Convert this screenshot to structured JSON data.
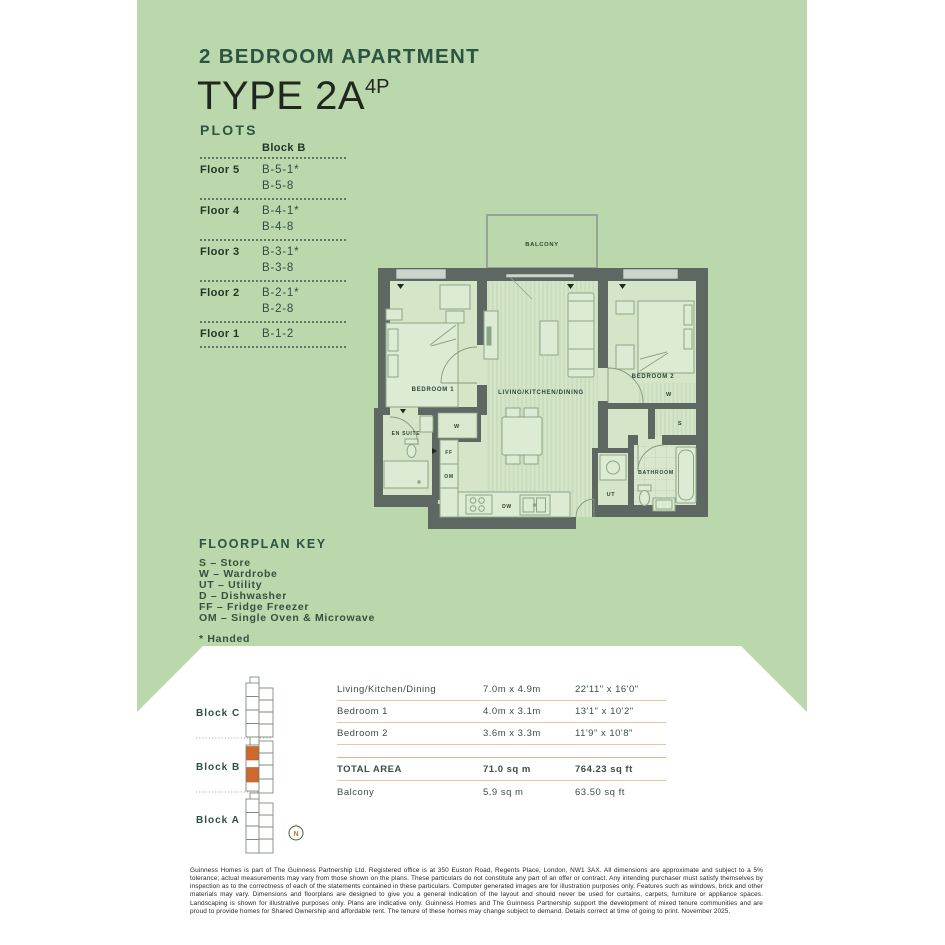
{
  "page": {
    "title_line1": "2 BEDROOM APARTMENT",
    "title_line2": "TYPE 2A",
    "title_superscript": "4P"
  },
  "plots": {
    "heading": "PLOTS",
    "column_header": "Block B",
    "rows": [
      {
        "floor": "Floor 5",
        "plots": [
          "B-5-1*",
          "B-5-8"
        ]
      },
      {
        "floor": "Floor 4",
        "plots": [
          "B-4-1*",
          "B-4-8"
        ]
      },
      {
        "floor": "Floor 3",
        "plots": [
          "B-3-1*",
          "B-3-8"
        ]
      },
      {
        "floor": "Floor 2",
        "plots": [
          "B-2-1*",
          "B-2-8"
        ]
      },
      {
        "floor": "Floor 1",
        "plots": [
          "B-1-2"
        ]
      }
    ]
  },
  "floorplan": {
    "labels": {
      "balcony": "BALCONY",
      "bedroom1": "BEDROOM 1",
      "living": "LIVING/KITCHEN/DINING",
      "bedroom2": "BEDROOM 2",
      "ensuite": "EN SUITE",
      "bathroom": "BATHROOM",
      "wardrobe": "W",
      "store": "S",
      "utility": "UT",
      "fridge_freezer": "FF",
      "oven_microwave": "OM",
      "dishwasher": "DW"
    }
  },
  "key": {
    "heading": "FLOORPLAN KEY",
    "items": [
      "S – Store",
      "W – Wardrobe",
      "UT – Utility",
      "D – Dishwasher",
      "FF – Fridge Freezer",
      "OM – Single Oven & Microwave"
    ],
    "note": "* Handed"
  },
  "siteplan": {
    "blocks": [
      "Block C",
      "Block B",
      "Block A"
    ],
    "compass": "N"
  },
  "dimensions": {
    "rows": [
      {
        "name": "Living/Kitchen/Dining",
        "metric": "7.0m x 4.9m",
        "imperial": "22'11\" x 16'0\""
      },
      {
        "name": "Bedroom 1",
        "metric": "4.0m x 3.1m",
        "imperial": "13'1\" x 10'2\""
      },
      {
        "name": "Bedroom 2",
        "metric": "3.6m x 3.3m",
        "imperial": "11'9\" x 10'8\""
      }
    ],
    "total": {
      "name": "TOTAL AREA",
      "metric": "71.0 sq m",
      "imperial": "764.23 sq ft"
    },
    "balcony": {
      "name": "Balcony",
      "metric": "5.9 sq m",
      "imperial": "63.50 sq ft"
    }
  },
  "disclaimer": "Guinness Homes is part of The Guinness Partnership Ltd. Registered office is at 350 Euston Road, Regents Place, London, NW1 3AX. All dimensions are approximate and subject to a 5% tolerance; actual measurements may vary from those shown on the plans. These particulars do not constitute any part of an offer or contract. Any intending purchaser must satisfy themselves by inspection as to the correctness of each of the statements contained in these particulars. Computer generated images are for illustration purposes only. Features such as windows, brick and other materials may vary. Dimensions and floorplans are designed to give you a general indication of the layout and should never be used for curtains, carpets, furniture or appliance spaces. Landscaping is shown for illustrative purposes only. Plans are indicative only. Guinness Homes and The Guinness Partnership support the development of mixed tenure communities and are proud to provide homes for Shared Ownership and affordable rent. The tenure of these homes may change subject to demand. Details correct at time of going to print. November 2025.",
  "colors": {
    "background_green": "#bad8ab",
    "heading_green": "#2d5343",
    "wall_grey": "#5c6861",
    "highlight_orange": "#cf6a2c",
    "table_rule": "#f0c29b"
  }
}
